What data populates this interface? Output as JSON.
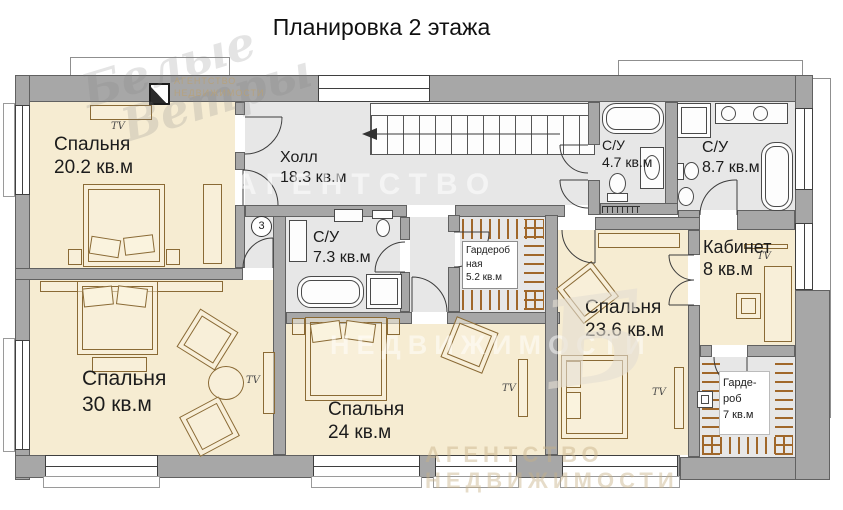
{
  "title": "Планировка 2 этажа",
  "rooms": {
    "bedroom_20": {
      "name": "Спальня",
      "area": "20.2 кв.м"
    },
    "hall": {
      "name": "Холл",
      "area": "18.3 кв.м"
    },
    "bath_47": {
      "name": "С/У",
      "area": "4.7 кв.м"
    },
    "bath_87": {
      "name": "С/У",
      "area": "8.7 кв.м"
    },
    "bath_73": {
      "name": "С/У",
      "area": "7.3 кв.м"
    },
    "dressing_52": {
      "line1": "Гардероб",
      "line2": "ная",
      "area": "5.2 кв.м"
    },
    "office": {
      "name": "Кабинет",
      "area": "8 кв.м"
    },
    "bedroom_236": {
      "name": "Спальня",
      "area": "23.6 кв.м"
    },
    "bedroom_30": {
      "name": "Спальня",
      "area": "30 кв.м"
    },
    "bedroom_24": {
      "name": "Спальня",
      "area": "24 кв.м"
    },
    "dressing_7": {
      "line1": "Гарде-",
      "line2": "роб",
      "area": "7 кв.м"
    }
  },
  "annotations": {
    "tv": "TV",
    "door_number": "3"
  },
  "watermark": {
    "script1": "Белые",
    "script2": "Ветры",
    "agency": "АГЕНТСТВО",
    "realty": "НЕДВИЖИМОСТИ"
  },
  "colors": {
    "room_fill": "#f6ecd2",
    "wet_fill": "#e7e7e7",
    "wall": "#a7a7a7",
    "furniture_line": "#8a6a35",
    "hatch": "#a0672a"
  }
}
